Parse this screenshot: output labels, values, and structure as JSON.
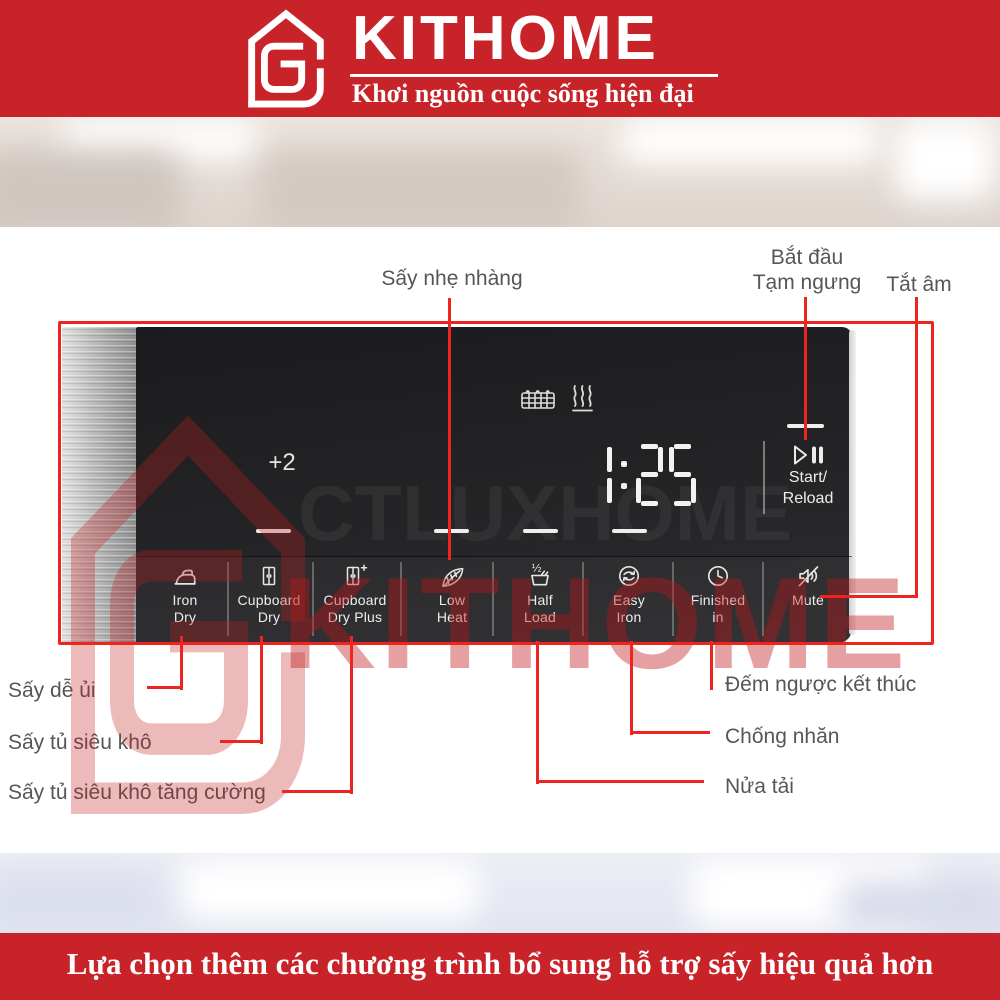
{
  "header": {
    "brand": "KITHOME",
    "tagline": "Khơi nguồn cuộc sống hiện đại"
  },
  "panel": {
    "display": {
      "time": "1:25",
      "aux_value": "+2"
    },
    "start_button": {
      "line1": "Start/",
      "line2": "Reload",
      "icon": "play-pause-icon"
    },
    "status_icons": [
      "drying-rack-icon",
      "heat-waves-icon"
    ],
    "buttons": [
      {
        "line1": "Iron",
        "line2": "Dry",
        "icon": "iron-icon"
      },
      {
        "line1": "Cupboard",
        "line2": "Dry",
        "icon": "cupboard-icon"
      },
      {
        "line1": "Cupboard",
        "line2": "Dry Plus",
        "icon": "cupboard-plus-icon"
      },
      {
        "line1": "Low",
        "line2": "Heat",
        "icon": "feather-icon"
      },
      {
        "line1": "Half",
        "line2": "Load",
        "icon": "half-load-icon"
      },
      {
        "line1": "Easy",
        "line2": "Iron",
        "icon": "easy-iron-icon"
      },
      {
        "line1": "Finished",
        "line2": "in",
        "icon": "clock-icon"
      },
      {
        "line1": "Mute",
        "line2": "",
        "icon": "mute-icon"
      }
    ]
  },
  "callouts": {
    "gentle_dry": "Sấy nhẹ nhàng",
    "start_line1": "Bắt đầu",
    "start_line2": "Tạm ngưng",
    "mute": "Tắt âm",
    "left": [
      "Sấy dễ ủi",
      "Sấy tủ siêu khô",
      "Sấy tủ siêu khô tăng cường"
    ],
    "right": [
      "Đếm ngược kết thúc",
      "Chống nhăn",
      "Nửa tải"
    ]
  },
  "watermark": {
    "brand": "KITHOME",
    "faint": "CTLUXHOME"
  },
  "footer": {
    "text": "Lựa chọn thêm các chương trình bổ sung hỗ trợ sấy hiệu quả hơn"
  },
  "colors": {
    "brand_red": "#c9232a",
    "callout_red": "#ee2420",
    "panel_black": "#242426",
    "callout_text": "#56565a"
  }
}
